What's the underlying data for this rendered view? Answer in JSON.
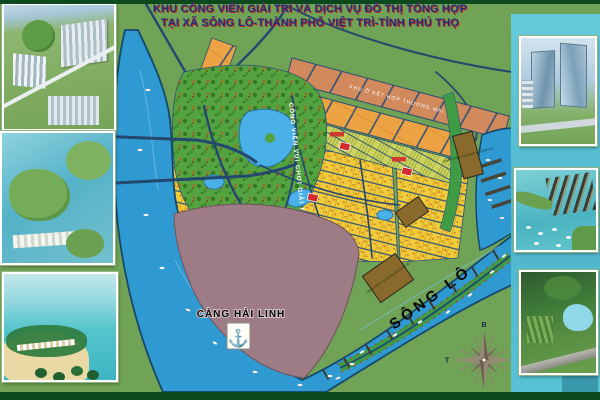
{
  "header": {
    "title_line1": "KHU CÔNG VIÊN GIẢI TRÍ VÀ DỊCH VỤ ĐÔ THỊ TỔNG HỢP",
    "title_line2": "TẠI XÃ SÔNG LÔ-THÀNH PHỐ VIỆT TRÌ-TỈNH PHÚ THỌ"
  },
  "map": {
    "river_label": "SÔNG LÔ",
    "port_label": "CẢNG HẢI LINH",
    "port_anchor_icon": "⚓",
    "park_label": "CÔNG VIÊN VUI CHƠI GIẢI TRÍ",
    "mixed_use_label": "KHU Ở KẾT HỢP THƯƠNG MẠI",
    "commercial_label": "CÔNG TRÌNH THƯƠNG MẠI DỊCH VỤ",
    "compass": {
      "north_label": "B",
      "south_label": "N",
      "east_label": "Đ",
      "west_label": "T"
    }
  },
  "sidebar_left": {
    "images": [
      {
        "name": "city-aerial-render"
      },
      {
        "name": "lakeside-district-render"
      },
      {
        "name": "beach-resort-render"
      }
    ]
  },
  "sidebar_right": {
    "images": [
      {
        "name": "office-towers-render"
      },
      {
        "name": "marina-docks-render"
      },
      {
        "name": "eco-park-render"
      }
    ]
  },
  "colors": {
    "river": "#2f9ad2",
    "land_green": "#70a355",
    "park_green": "#54a341",
    "port_mauve": "#9e7c86",
    "road_navy": "#24486f",
    "villa_yellow": "#f0cb3a",
    "highrise_salmon": "#d2895c",
    "highrise_orange": "#eda344",
    "rowhouse_olive": "#ccd45f",
    "commercial_brown": "#8a6a2c",
    "waterfront_green": "#3f9c45",
    "panel_cyan": "#56c2d6",
    "accent_teal": "#3a98ac",
    "strip_dark_green": "#0c4a1e",
    "title_blue": "#232e7d",
    "title_shadow_red": "#bb2d20"
  }
}
